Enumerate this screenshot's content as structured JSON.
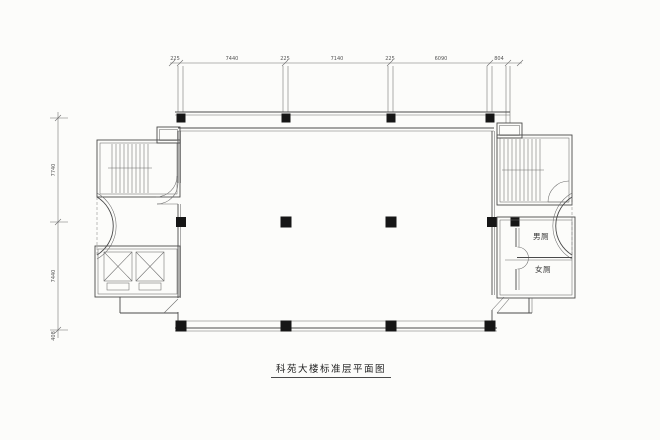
{
  "title": {
    "text": "科苑大楼标准层平面图"
  },
  "rooms": {
    "male_toilet": "男厕",
    "female_toilet": "女厕"
  },
  "dimensions": {
    "top": [
      "225",
      "7440",
      "225",
      "7140",
      "225",
      "6090",
      "804"
    ],
    "left": [
      "7740",
      "7440",
      "408"
    ]
  },
  "colors": {
    "background": "#fcfcfa",
    "line": "#4a4a4a",
    "column": "#161616",
    "dim_text": "#555555"
  }
}
